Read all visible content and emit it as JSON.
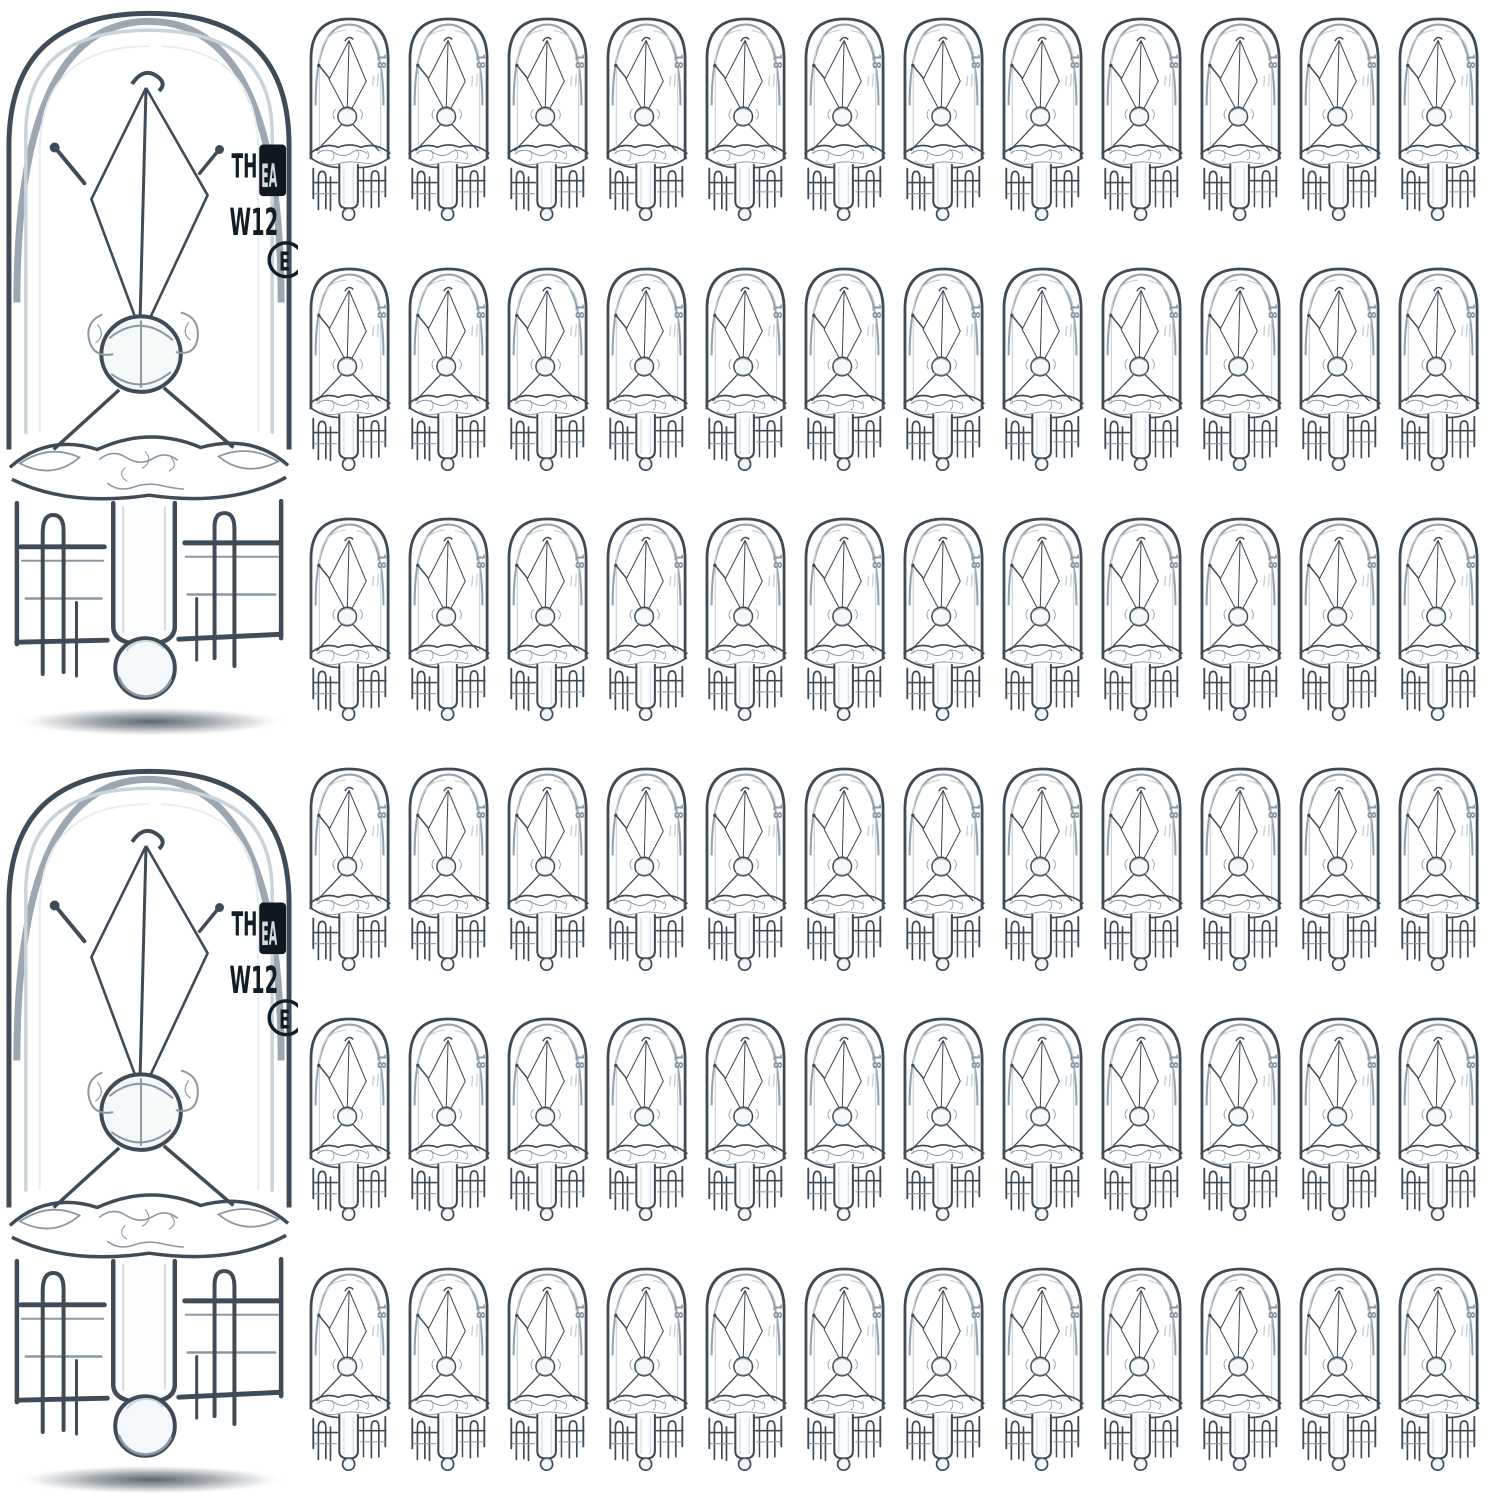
{
  "scene": {
    "type": "product-photo",
    "subject": "Clear glass T10 W5W wedge-base miniature bulbs, two large close-ups and a grid of small bulbs",
    "background_color": "#ffffff"
  },
  "large_bulbs": {
    "count": 2,
    "positions": [
      "top-left",
      "bottom-left"
    ],
    "markings": {
      "line1_prefix": "TH",
      "logo_text": "EA",
      "line2": "W12",
      "cert_mark": "E"
    }
  },
  "small_bulbs": {
    "rows": 6,
    "columns": 12,
    "count": 72,
    "marking": "18"
  },
  "colors": {
    "background": "#ffffff",
    "glass_dark": "#3f4b56",
    "glass_mid": "#8b98a3",
    "glass_light": "#c9d4da",
    "glass_highlight": "#e7edf1",
    "marking_text": "#131d26",
    "logo_box": "#101921",
    "logo_glyph": "#cfd9e0",
    "shadow": "#4f5a63"
  }
}
